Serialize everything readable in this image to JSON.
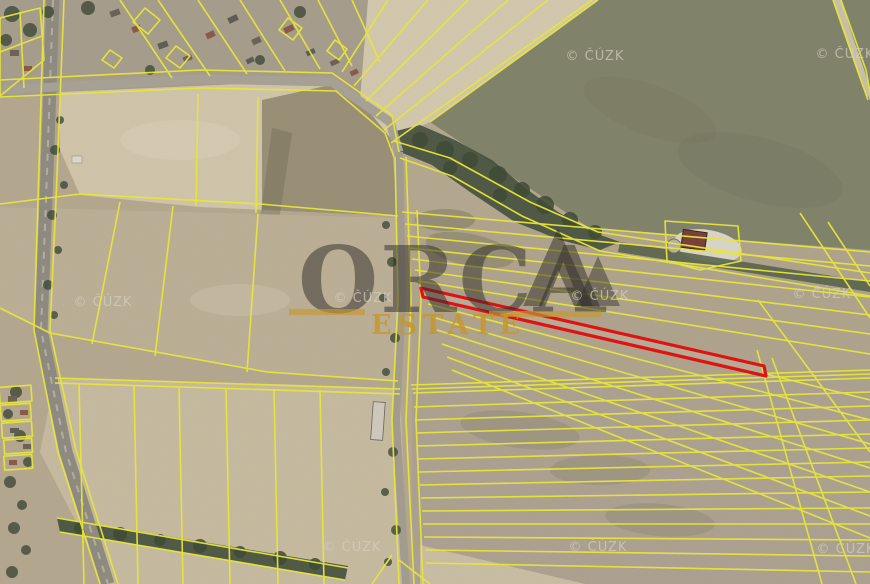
{
  "map": {
    "brand_watermark": {
      "name": "ORCA",
      "subtitle": "ESTATE"
    },
    "copyright_watermark": "© ČÚZK",
    "colors": {
      "parcel_line": "#e9e93a",
      "highlighted_parcel": "#e01212",
      "brand_text": "#2e2c28",
      "brand_subtitle": "#c7992e",
      "copyright_text": "#d6d2c6",
      "field_tan": "#b5a88f",
      "field_pale": "#d0c5ab",
      "field_green": "#82836b",
      "forest": "#46523f",
      "road": "#a39d90"
    }
  }
}
